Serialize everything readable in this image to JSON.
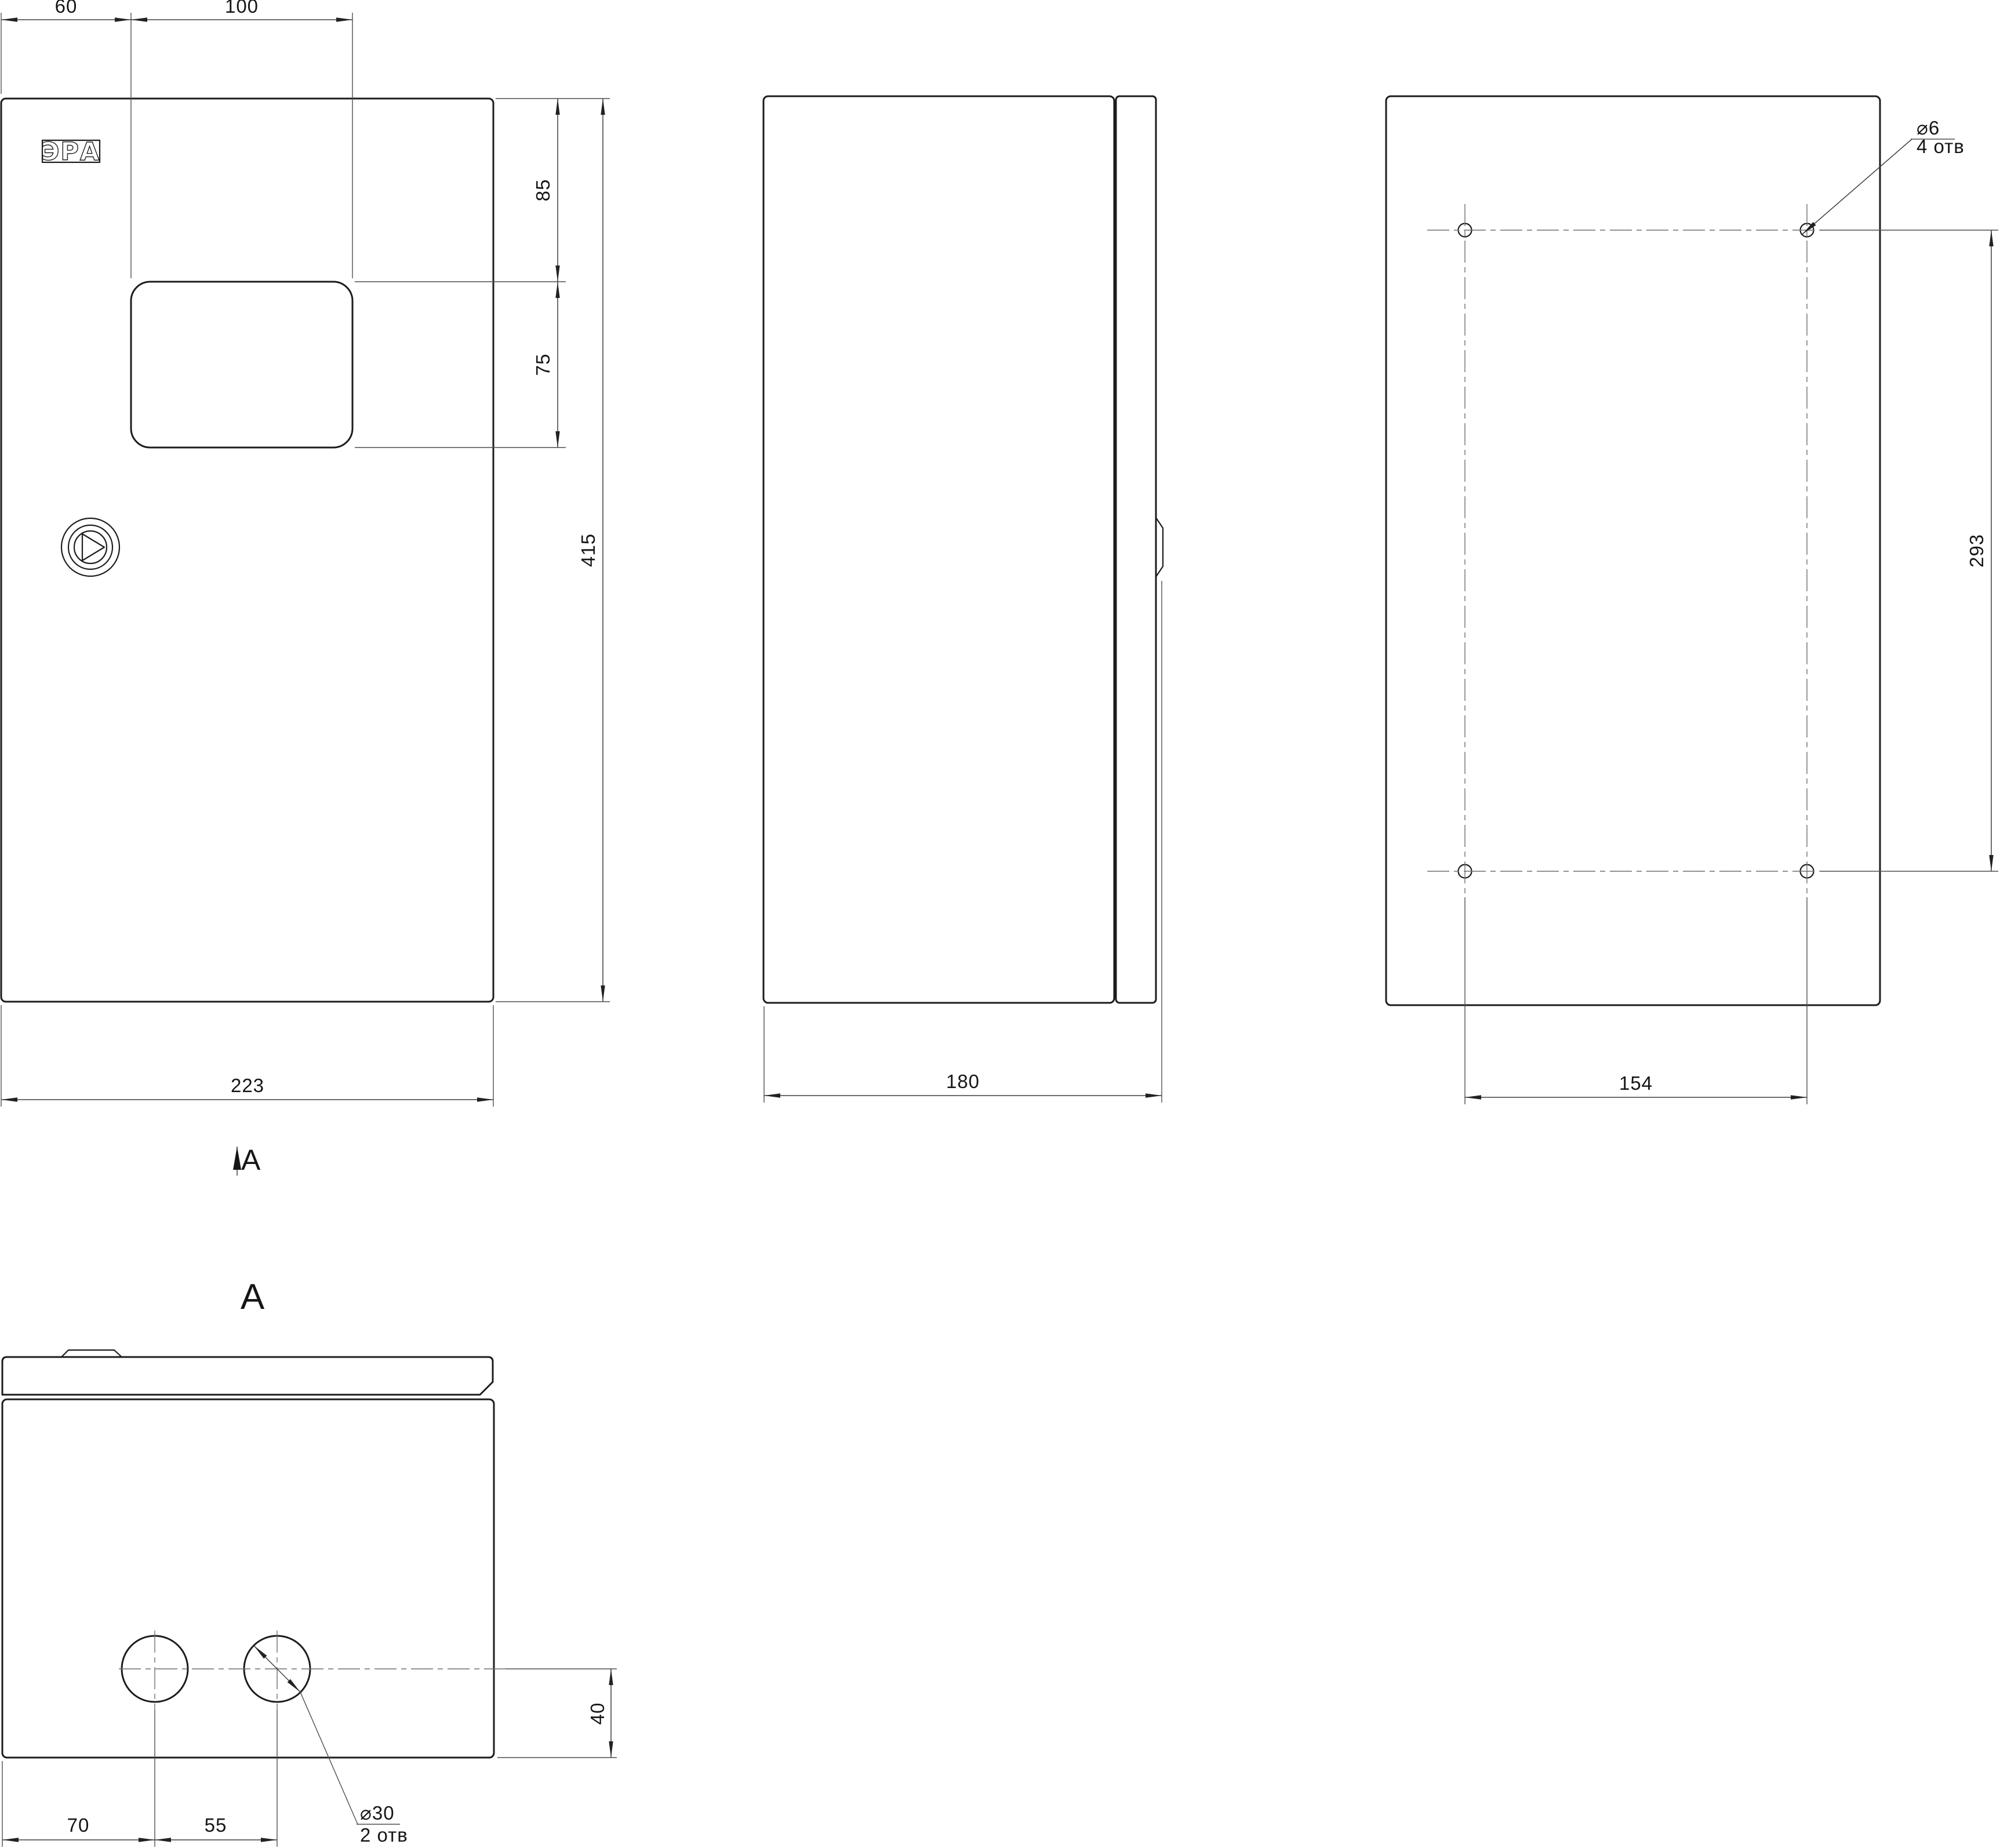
{
  "colors": {
    "background": "#ffffff",
    "outline": "#1c1c1c",
    "thin_line": "#4f4f4f",
    "centerline": "#6e6e6e",
    "text": "#161616"
  },
  "front_view": {
    "logo_text": "ЭРА",
    "section_label": "A",
    "dims": {
      "left_to_window": "60",
      "window_width": "100",
      "top_to_window": "85",
      "window_height": "75",
      "height": "415",
      "width": "223"
    }
  },
  "side_view": {
    "dims": {
      "depth": "180"
    }
  },
  "back_view": {
    "callout": {
      "diameter": "⌀6",
      "qty": "4 отв"
    },
    "dims": {
      "hole_span_vertical": "293",
      "hole_span_horizontal": "154"
    }
  },
  "bottom_view": {
    "title": "A",
    "callout": {
      "diameter": "⌀30",
      "qty": "2 отв"
    },
    "dims": {
      "hole_offset_bottom": "40",
      "edge_to_first_hole": "70",
      "hole_pitch": "55"
    }
  }
}
